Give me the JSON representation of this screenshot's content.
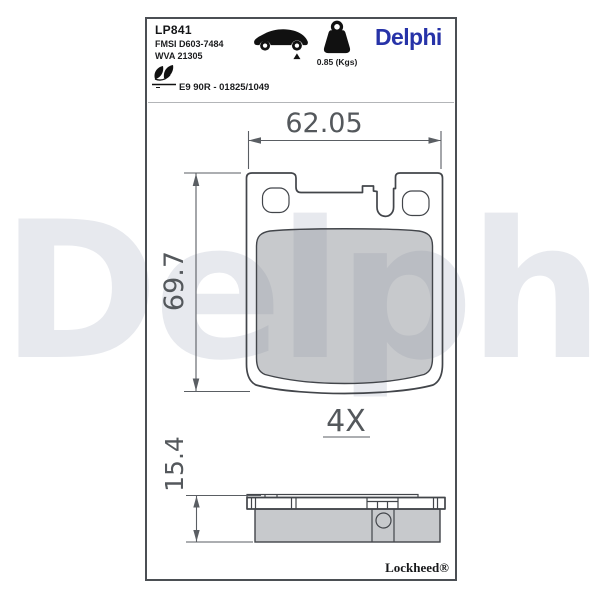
{
  "watermark": {
    "text": "Delphi",
    "color": "#e7e9ee"
  },
  "header": {
    "part_number": "LP841",
    "fmsi_ref": "FMSI D603-7484",
    "wva_ref": "WVA 21305",
    "weight": "0.85 (Kgs)",
    "brand": "Delphi",
    "brand_color": "#2733a8",
    "approval": "E9 90R - 01825/1049"
  },
  "dimensions": {
    "width": "62.05",
    "height": "69.7",
    "thickness": "15.4",
    "quantity": "4X"
  },
  "footer": {
    "trademark": "Lockheed®"
  }
}
